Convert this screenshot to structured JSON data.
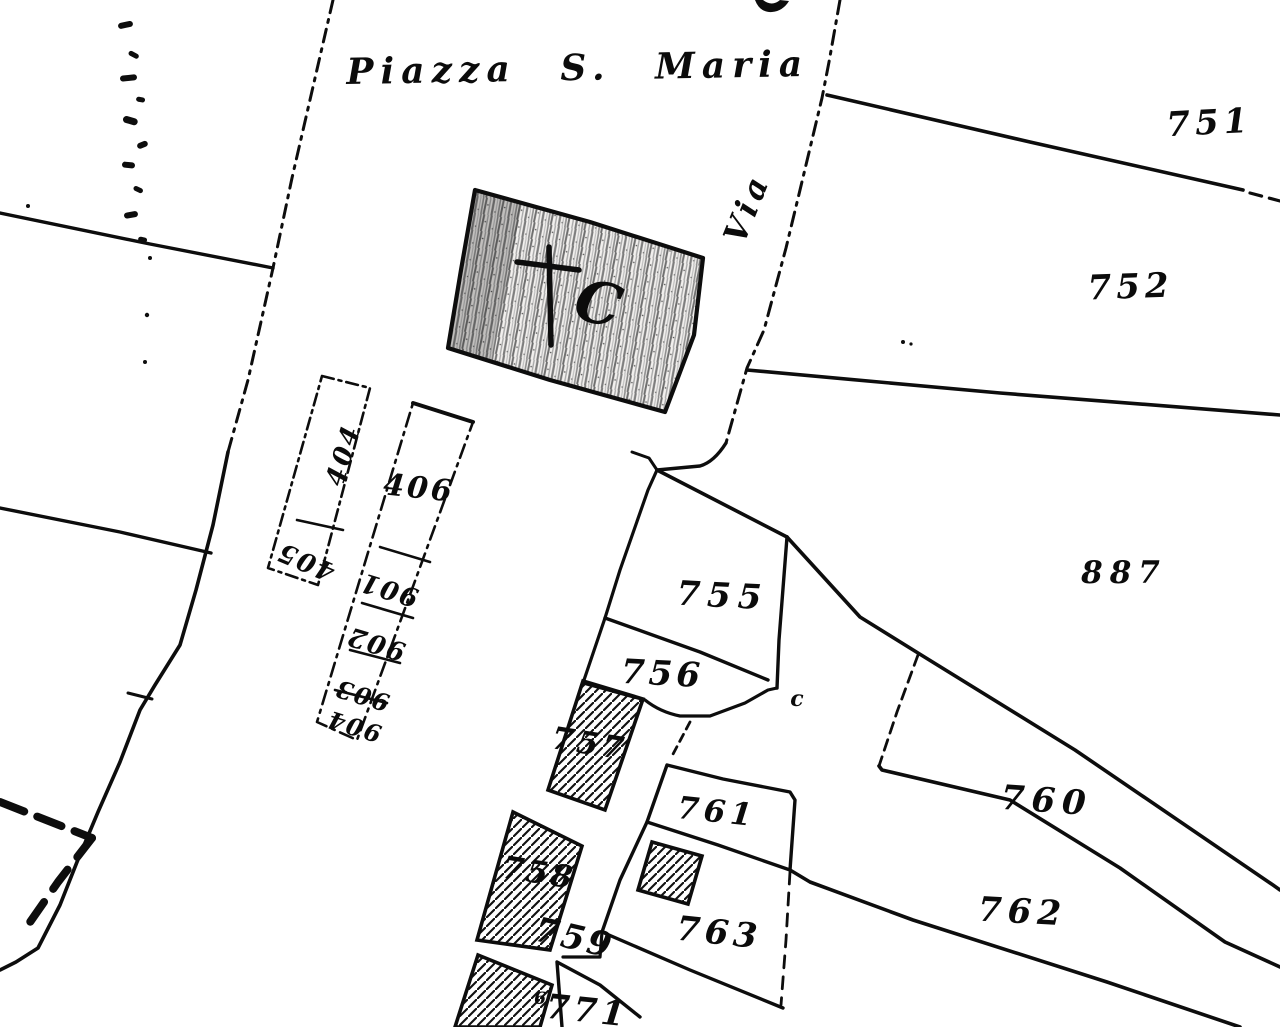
{
  "map_title": "Cadastral sketch - Piazza S. Maria",
  "colors": {
    "ink": "#0d0d0d",
    "paper": "#ffffff",
    "church_shading": "#9a9a9a"
  },
  "streets": {
    "piazza": "Piazza S. Maria",
    "via": "Via"
  },
  "church": {
    "letter": "C",
    "symbol": "latin-cross-icon"
  },
  "parcels": {
    "p751": "751",
    "p752": "752",
    "p887": "887",
    "p755": "755",
    "p756": "756",
    "p757": "757",
    "p758": "758",
    "p759": "759",
    "p760": "760",
    "p761": "761",
    "p762": "762",
    "p763": "763",
    "p771": "771",
    "p404": "404",
    "p405": "405",
    "p406": "406",
    "p901": "901",
    "p902": "902",
    "p903": "903",
    "p904": "904"
  },
  "stray_marks": {
    "small_c": "c",
    "small_six": "6"
  }
}
